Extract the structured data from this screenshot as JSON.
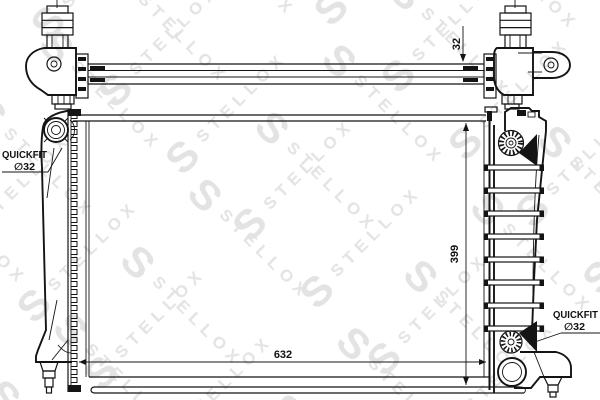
{
  "watermark": {
    "letter": "S",
    "text": "STELLOX",
    "color": "#e3e3e3"
  },
  "colors": {
    "background": "#ffffff",
    "line": "#141414"
  },
  "dimensions": {
    "tube_height": "32",
    "core_height": "399",
    "core_width": "632"
  },
  "labels": {
    "quickfit_left": {
      "title": "QUICKFIT",
      "size": "∅32"
    },
    "quickfit_right": {
      "title": "QUICKFIT",
      "size": "∅32"
    }
  }
}
